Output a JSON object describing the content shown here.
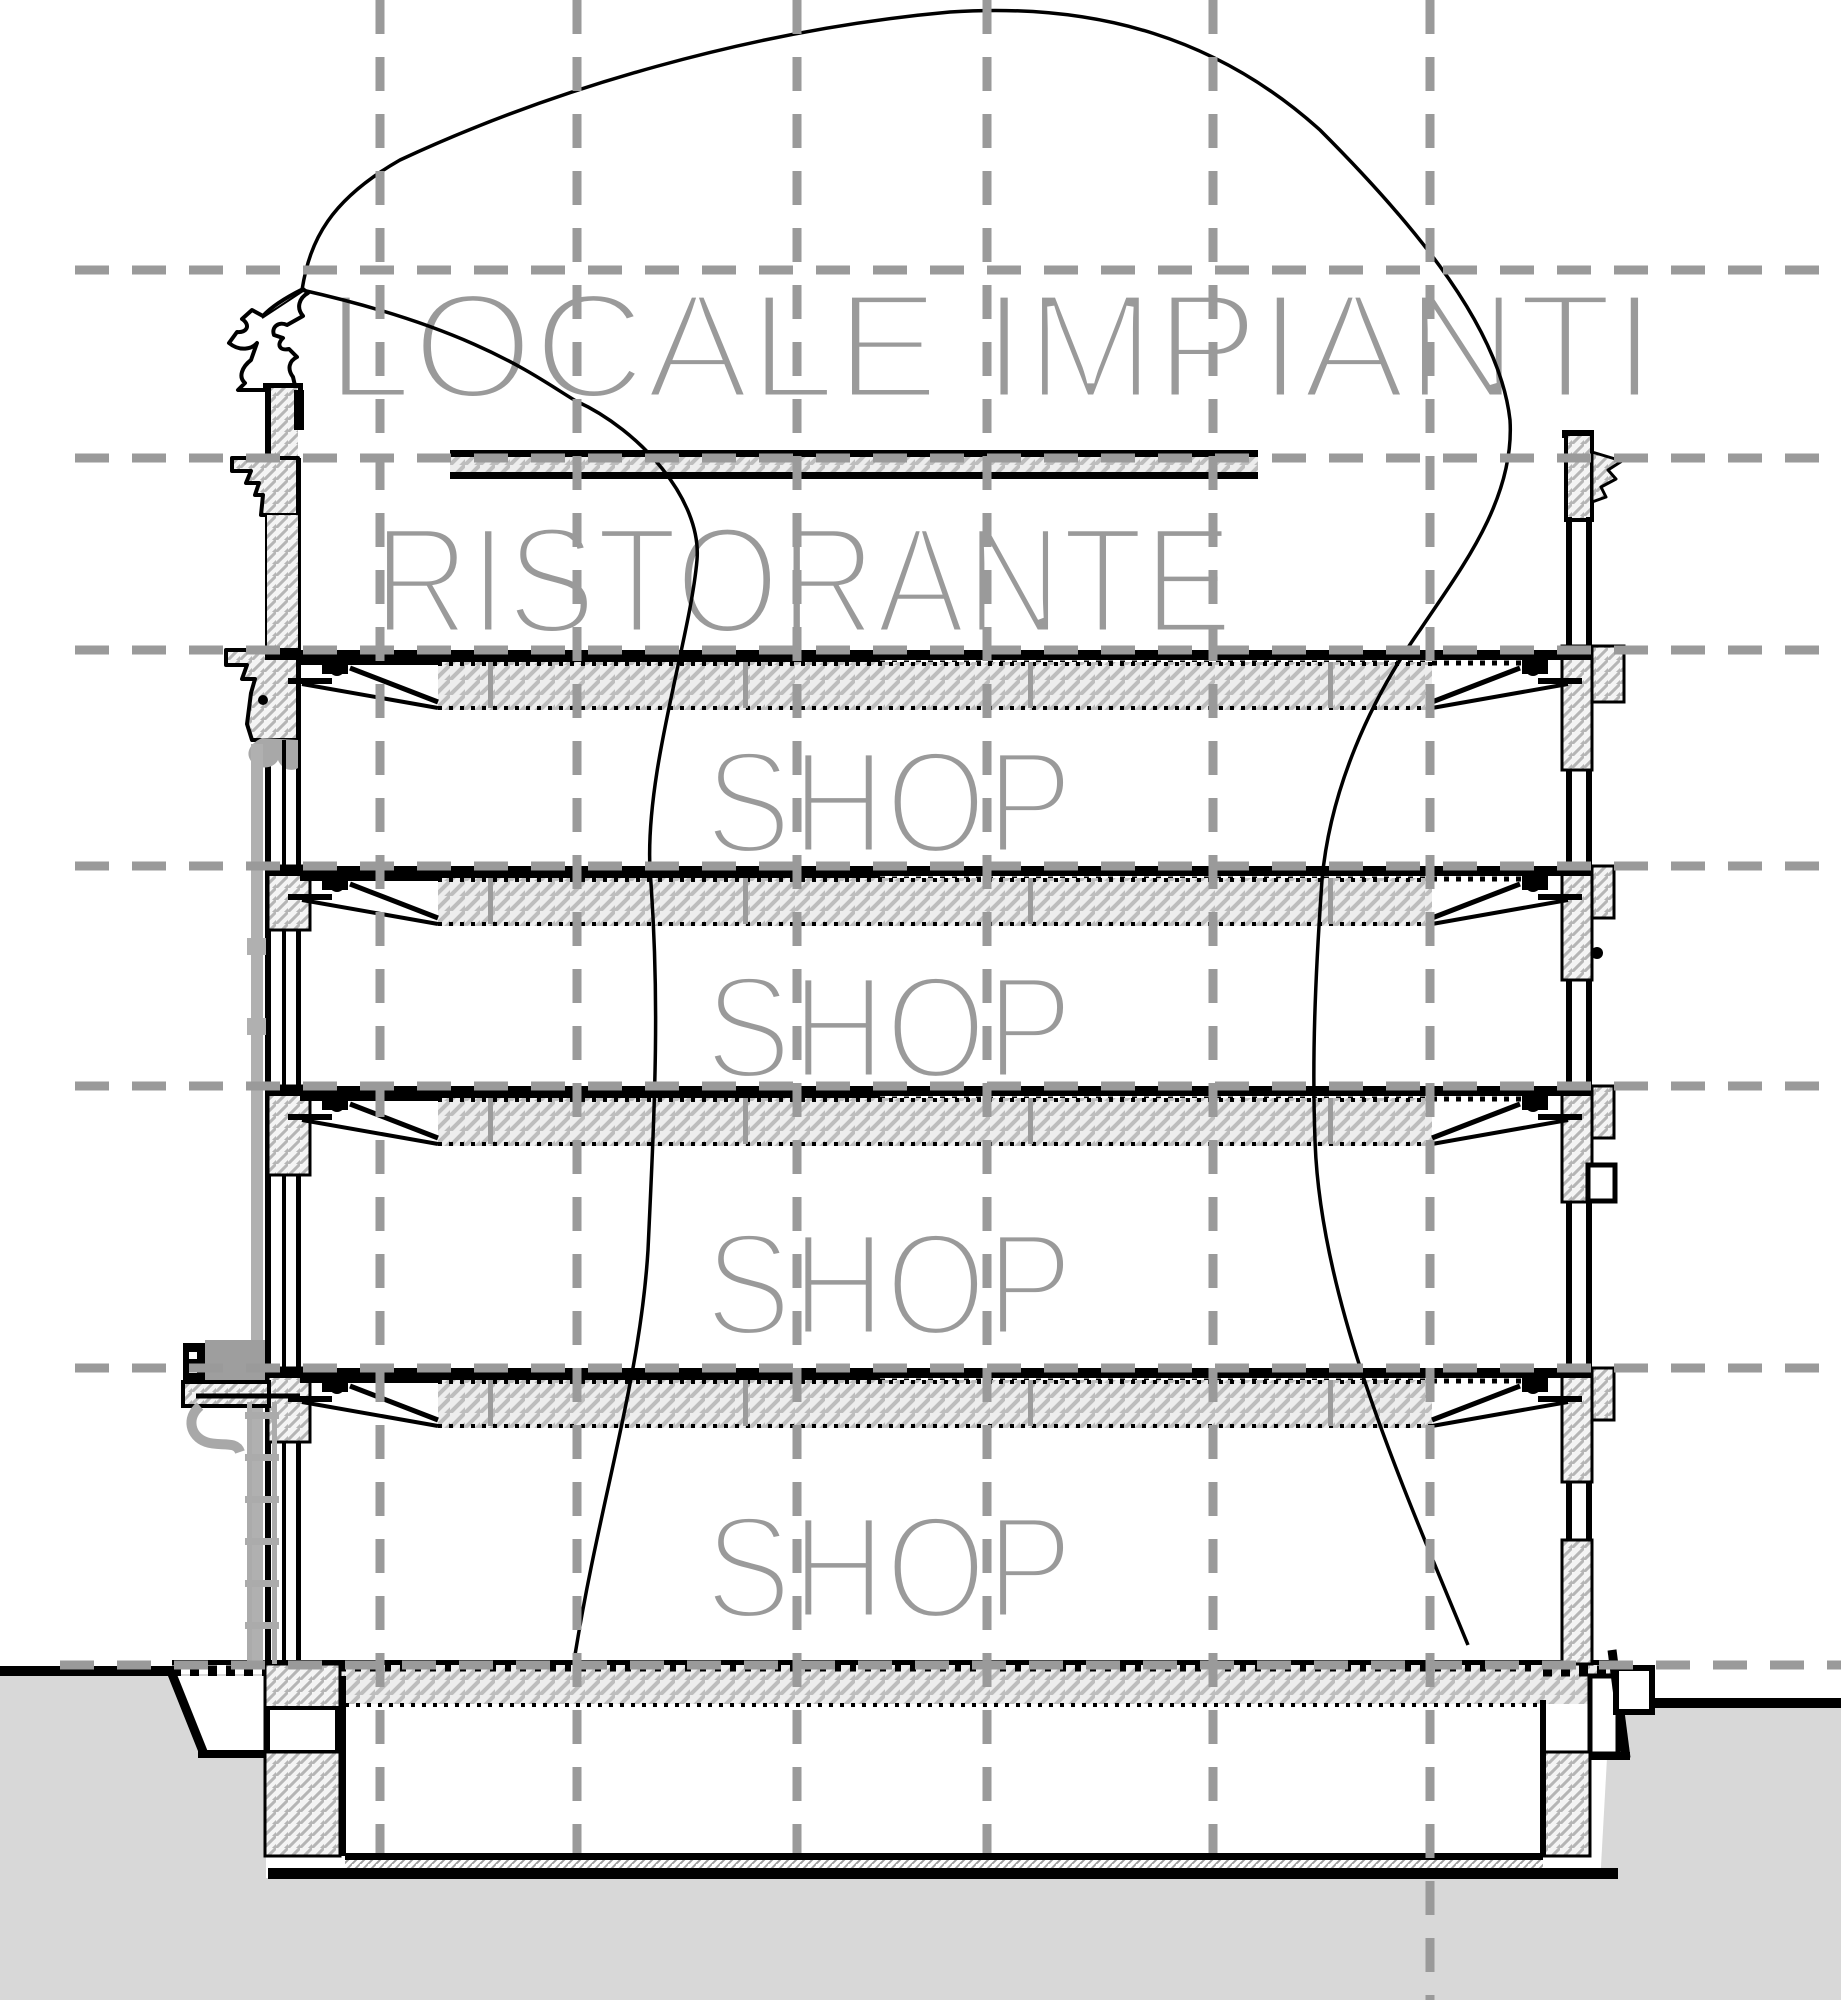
{
  "drawing": {
    "title": "Building cross-section",
    "labels": {
      "plant_room": "LOCALE IMPIANTI",
      "restaurant": "RISTORANTE",
      "shops": [
        "SHOP",
        "SHOP",
        "SHOP",
        "SHOP"
      ]
    },
    "colors": {
      "line": "#000000",
      "grid": "#9a9a9a",
      "label_text": "#9a9a9a",
      "ground_fill": "#d8d8d8",
      "hatch_line": "#bdbdbd",
      "pipe_gray": "#ababab"
    }
  }
}
